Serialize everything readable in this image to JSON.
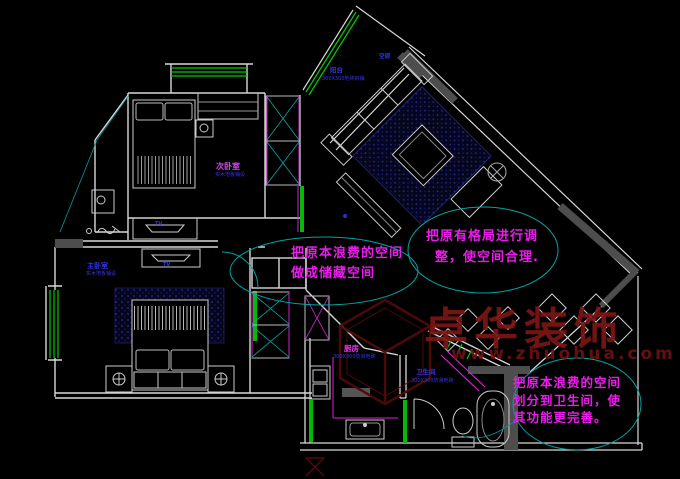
{
  "app": {
    "type": "cad-floor-plan",
    "background": "#000000"
  },
  "colors": {
    "wall": "#d8d8d8",
    "window_green": "#00cc00",
    "annotation_magenta": "#ea1cea",
    "revision_cloud_cyan": "#00a5a5",
    "label_blue": "#3434ee",
    "hatch_navy": "#2a2aa0",
    "watermark_red": "#7c1616"
  },
  "rooms": {
    "balcony": {
      "name": "阳台",
      "finish": "300X300地砖斜铺"
    },
    "secondary_bedroom": {
      "name": "次卧室",
      "finish": "实木地板铺设"
    },
    "master_bedroom": {
      "name": "主卧室",
      "finish": "实木地板铺设"
    },
    "kitchen": {
      "name": "厨房",
      "finish": "300X300防滑地砖"
    },
    "bathroom": {
      "name": "卫生间",
      "finish": "300X300防滑地砖"
    },
    "ac_unit": {
      "name": "空调"
    }
  },
  "furniture_labels": {
    "tv": "TV"
  },
  "annotations": [
    {
      "lines": [
        "把原本浪费的空间",
        "做成储藏空间"
      ]
    },
    {
      "lines": [
        "把原有格局进行调",
        "整，使空间合理."
      ]
    },
    {
      "lines": [
        "把原本浪费的空间",
        "划分到卫生间，使",
        "其功能更完善。"
      ]
    }
  ],
  "watermark": {
    "brand": "卓华装饰",
    "url": "www.zhuohua.com"
  }
}
